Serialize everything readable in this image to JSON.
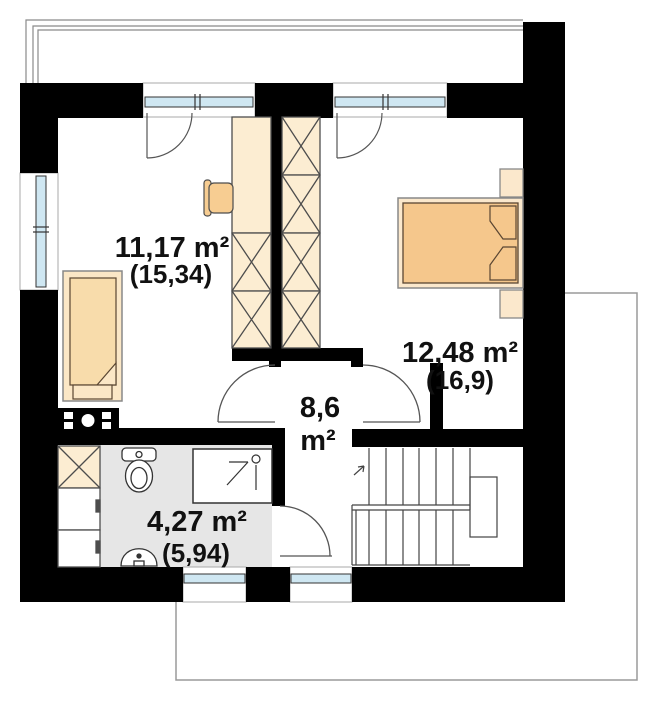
{
  "plan": {
    "rooms": {
      "room1": {
        "area": "11,17 m²",
        "area_gross": "(15,34)"
      },
      "room2": {
        "area": "12,48 m²",
        "area_gross": "(16,9)"
      },
      "hall": {
        "area": "8,6",
        "unit": "m²"
      },
      "bathroom": {
        "area": "4,27 m²",
        "area_gross": "(5,94)"
      }
    },
    "colors": {
      "wall": "#000000",
      "furniture_fill": "#fcedd2",
      "bed_fill": "#f5c78c",
      "bed_frame": "#fbe8cc",
      "window_glass": "#cfe7f2",
      "bathroom_floor": "#e6e6e6",
      "outline_gray": "#8a8a8a"
    },
    "symbols": [
      "wardrobe",
      "desk",
      "chair",
      "single-bed",
      "double-bed",
      "nightstand",
      "chimney-flue",
      "toilet",
      "shower",
      "washbasin",
      "washing-machine",
      "cabinet",
      "stairs",
      "door-swing",
      "window"
    ]
  }
}
